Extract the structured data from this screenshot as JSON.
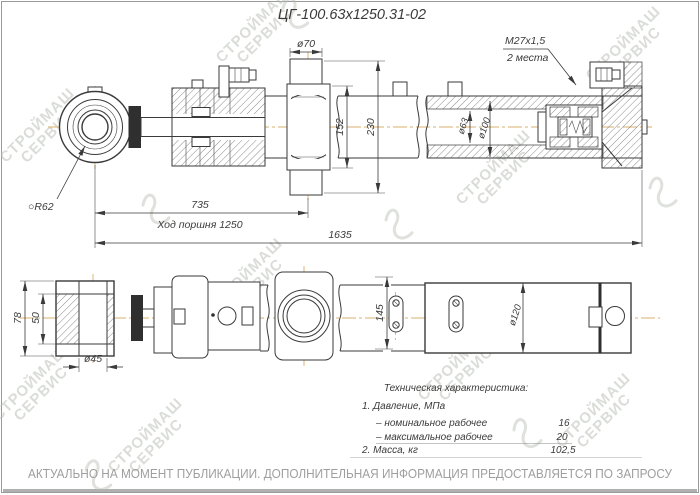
{
  "title": "ЦГ-100.63х1250.31-02",
  "dimensions": {
    "d70": "ø70",
    "m27": "М27х1,5",
    "m27_note": "2 места",
    "r62": "○R62",
    "dim152": "152",
    "dim230": "230",
    "d63": "ø63",
    "d100": "ø100",
    "dim735": "735",
    "stroke_note": "Ход поршня 1250",
    "dim1635": "1635",
    "dim78": "78",
    "dim50": "50",
    "d45": "ø45",
    "dim145": "145",
    "d120": "ø120"
  },
  "tech_specs": {
    "title": "Техническая характеристика:",
    "row1": "1. Давление, МПа",
    "row2_label": "– номинальное рабочее",
    "row2_value": "16",
    "row3_label": "– максимальное рабочее",
    "row3_value": "20",
    "row4_label": "2. Масса, кг",
    "row4_value": "102,5"
  },
  "footer": {
    "disclaimer": "АКТУАЛЬНО НА МОМЕНТ ПУБЛИКАЦИИ. ДОПОЛНИТЕЛЬНАЯ ИНФОРМАЦИЯ ПРЕДОСТАВЛЯЕТСЯ ПО ЗАПРОСУ"
  },
  "watermark": {
    "line1": "СТРОЙМАШ",
    "line2": "СЕРВИС"
  },
  "colors": {
    "line": "#3a3a3a",
    "centerline": "#d8b06c",
    "watermark": "#b7bcb1",
    "footer_text": "#9e9e9e"
  }
}
